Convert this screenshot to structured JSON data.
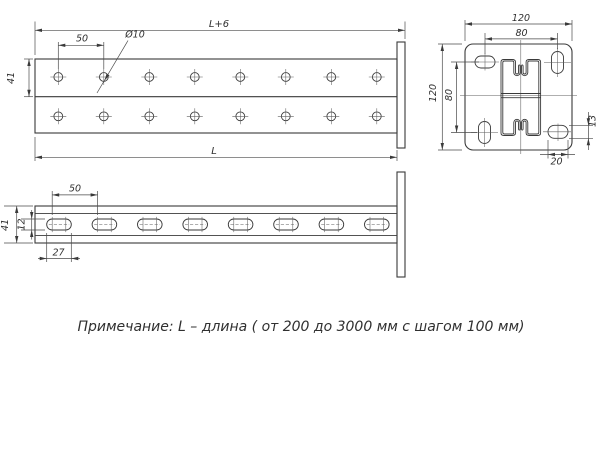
{
  "drawing": {
    "note": "Примечание: L – длина ( от 200 до 3000 мм с шагом 100 мм)",
    "front_view": {
      "dim_overall_length": "L+6",
      "dim_hole_pitch": "50",
      "dim_hole_diameter": "Ø10",
      "dim_channel_height": "41",
      "dim_length": "L"
    },
    "end_view": {
      "dim_plate_width": "120",
      "dim_hole_spacing_horizontal": "80",
      "dim_plate_height": "120",
      "dim_hole_spacing_vertical": "80",
      "dim_slot_width": "13",
      "dim_slot_length": "20"
    },
    "plan_view": {
      "dim_slot_pitch": "50",
      "dim_channel_width": "41",
      "dim_slot_width": "12",
      "dim_slot_length": "27"
    }
  },
  "colors": {
    "line": "#3a3a3a",
    "dimension": "#4a4a4a",
    "text": "#303030",
    "background": "#ffffff"
  }
}
